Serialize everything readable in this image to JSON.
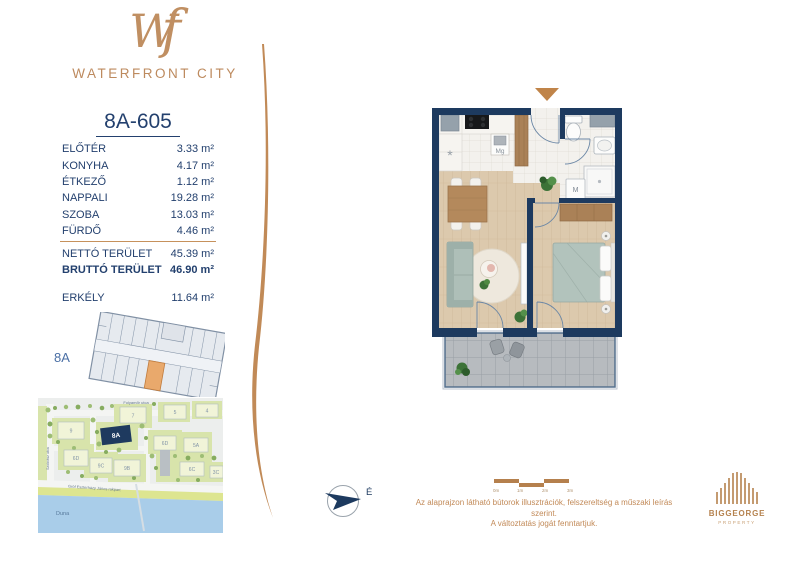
{
  "brand": {
    "monogram_w": "W",
    "monogram_f": "f",
    "name": "WATERFRONT CITY"
  },
  "unit": {
    "id": "8A-605",
    "rooms": [
      {
        "label": "ELŐTÉR",
        "area": "3.33 m²"
      },
      {
        "label": "KONYHA",
        "area": "4.17 m²"
      },
      {
        "label": "ÉTKEZŐ",
        "area": "1.12 m²"
      },
      {
        "label": "NAPPALI",
        "area": "19.28 m²"
      },
      {
        "label": "SZOBA",
        "area": "13.03 m²"
      },
      {
        "label": "FÜRDŐ",
        "area": "4.46 m²"
      }
    ],
    "net": {
      "label": "NETTÓ TERÜLET",
      "area": "45.39 m²"
    },
    "gross": {
      "label": "BRUTTÓ TERÜLET",
      "area": "46.90 m²"
    },
    "balcony": {
      "label": "ERKÉLY",
      "area": "11.64 m²"
    }
  },
  "key_plan": {
    "building": "8A"
  },
  "floor_plan": {
    "labels": {
      "fridge": "*",
      "microwave": "Mg",
      "washer": "M"
    }
  },
  "site_map": {
    "streets": {
      "top": "Folyamőr utca",
      "left": "Szobrász utca",
      "embankment": "Gróf Eszterházy János rakpart",
      "river": "Duna"
    },
    "highlight": "8A",
    "labels": {
      "b9": "9",
      "b7": "7",
      "b5": "5",
      "b4": "4",
      "b6d_r": "6D",
      "b5a": "5A",
      "b6d_l": "6D",
      "b9c": "9C",
      "b9b": "9B",
      "b6c": "6C",
      "b3c": "3C"
    }
  },
  "compass": {
    "north": "É"
  },
  "scale_bar": {
    "ticks": [
      "0m",
      "1m",
      "2m",
      "3m"
    ]
  },
  "disclaimer": {
    "line1": "Az alaprajzon látható bútorok illusztrációk, felszereltség a műszaki leírás szerint.",
    "line2": "A változtatás jogát fenntartjuk."
  },
  "developer": {
    "name": "BIGGEORGE",
    "division": "PROPERTY"
  },
  "colors": {
    "bronze": "#bd8a5e",
    "navy": "#1d3a5f",
    "text_navy": "#23406e"
  }
}
